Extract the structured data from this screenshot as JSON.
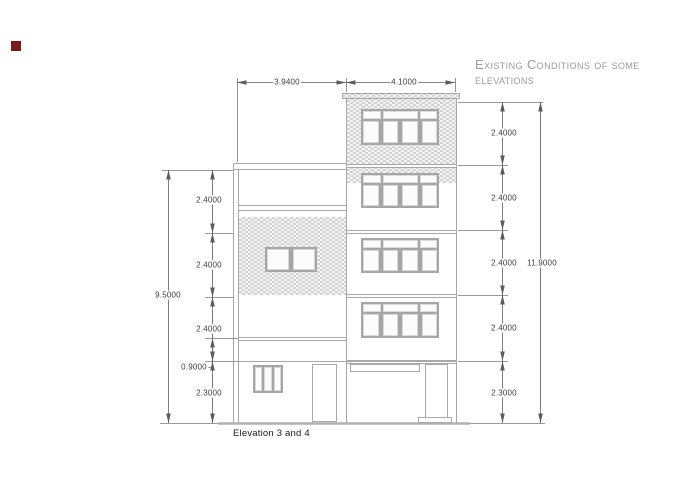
{
  "title": "Existing Conditions of some elevations",
  "drawing_label": "Elevation 3 and 4",
  "dims": {
    "width_left": "3.9400",
    "width_right": "4.1000",
    "left_total": "9.5000",
    "left_f1": "2.4000",
    "left_f2": "2.4000",
    "left_f3": "2.4000",
    "left_band": "0.9000",
    "left_ground": "2.3000",
    "right_f1": "2.4000",
    "right_f2": "2.4000",
    "right_f3": "2.4000",
    "right_f4": "2.4000",
    "right_ground": "2.3000",
    "right_total": "11.9000"
  },
  "colors": {
    "building_line": "#a8a8a8",
    "dimension_line": "#5c5c5c",
    "brick_hatch": "#d3d3d3",
    "title_text": "#9b9b99",
    "corner_marker": "#7a1a1a"
  }
}
